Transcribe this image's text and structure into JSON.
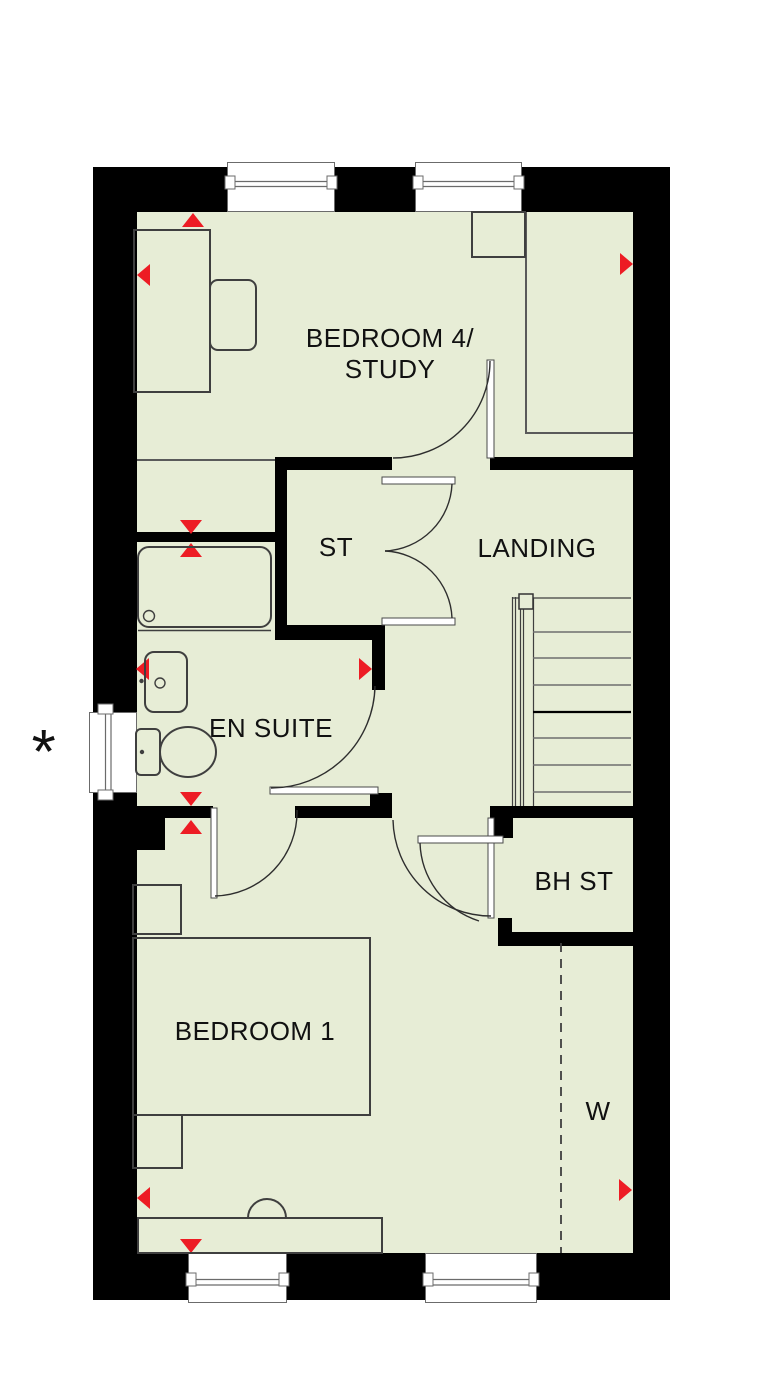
{
  "labels": {
    "bedroom4_line1": "BEDROOM 4/",
    "bedroom4_line2": "STUDY",
    "storage": "ST",
    "landing": "LANDING",
    "ensuite": "EN SUITE",
    "boiler_store": "BH ST",
    "bedroom1": "BEDROOM 1",
    "wardrobe": "W",
    "asterisk": "*"
  },
  "colors": {
    "floor": "#e7edd6",
    "wall": "#000000",
    "marker": "#ed1c24",
    "line": "#3f3f3f",
    "frame": "#6b6b6b"
  }
}
